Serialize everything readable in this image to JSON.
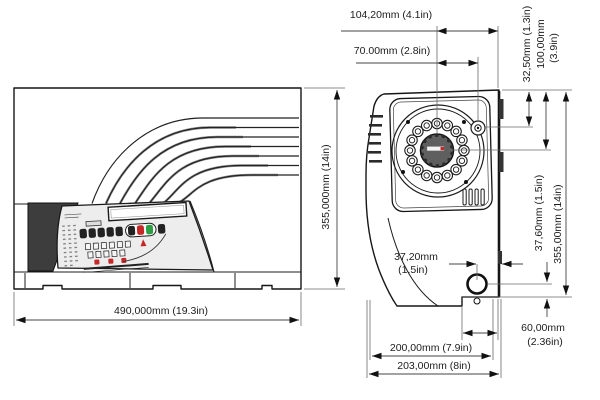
{
  "drawing": {
    "front_view": {
      "width_label": "490,000mm (19.3in)",
      "height_label": "355,000mm (14in)"
    },
    "side_view": {
      "hub_to_rear_label": "104,20mm (4.1in)",
      "hub_to_port_label": "70.00mm (2.8in)",
      "port_from_top_label": "32,50mm (1.3in)",
      "hub_from_top_label_mm": "100,00mm",
      "hub_from_top_label_in": "(3.9in)",
      "socket_from_bottom_label": "37,60mm (1.5in)",
      "height_label": "355,00mm (14in)",
      "socket_from_rear_label_mm": "37,20mm",
      "socket_from_rear_label_in": "(1.5in)",
      "foot_width_label_mm": "60,00mm",
      "foot_width_label_in": "(2.36in)",
      "body_depth_label": "200,00mm (7.9in)",
      "total_depth_label": "203,00mm (8in)"
    },
    "colors": {
      "line": "#1a1a1a",
      "dimension_line": "#555555",
      "panel_fill": "#ededed",
      "dark_fill": "#3d3d3d",
      "button_red": "#c62828",
      "button_green": "#2e9e44",
      "hub_fill": "#5f5f5f"
    }
  }
}
